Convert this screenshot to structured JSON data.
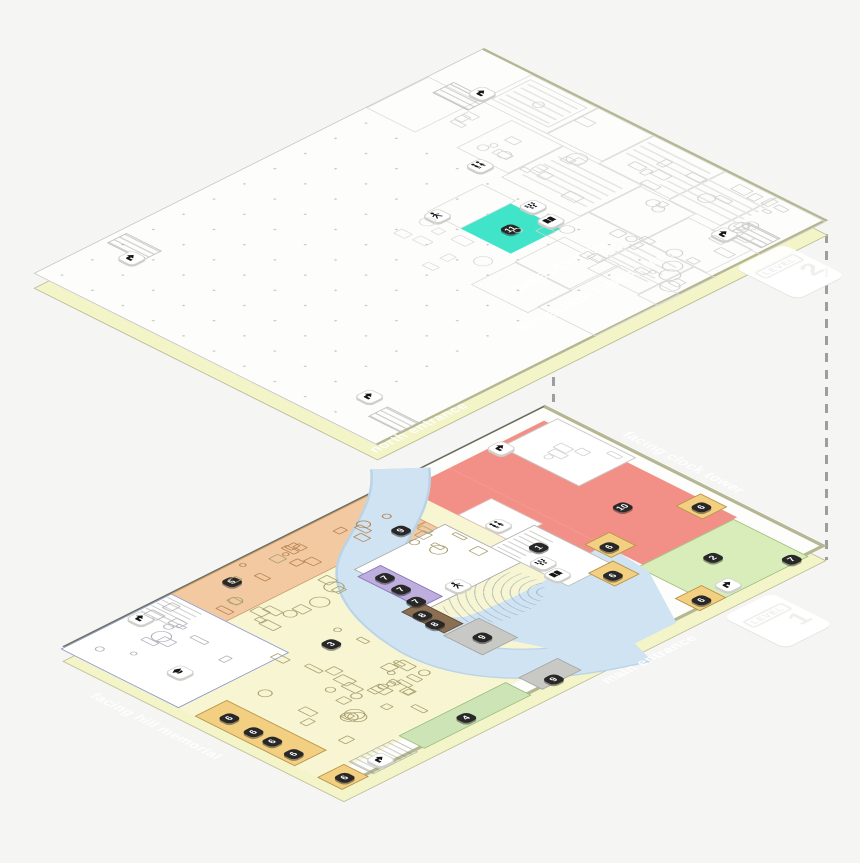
{
  "scene": {
    "background": "#f5f5f4"
  },
  "level2": {
    "badge": {
      "label": "LEVEL",
      "number": "2"
    },
    "highlight_room_color": "#3fe4c9",
    "room_labels": [
      {
        "text": "RECEPTION",
        "p": 286,
        "v": 191
      },
      {
        "text": "CONF.",
        "p": 288,
        "v": 243
      },
      {
        "text": "RESEARCH LIBRARIANS",
        "p": 334,
        "v": 205
      }
    ],
    "markers": [
      {
        "label": "11",
        "p": 210,
        "v": 178
      }
    ],
    "icons": [
      {
        "type": "stairs-icon",
        "p": 40,
        "v": 40
      },
      {
        "type": "stairs-icon",
        "p": 28,
        "v": 420
      },
      {
        "type": "stairs-icon",
        "p": 316,
        "v": 442
      },
      {
        "type": "stairs-icon",
        "p": 333,
        "v": 62
      },
      {
        "type": "restroom-icon",
        "p": 120,
        "v": 122
      },
      {
        "type": "person-icon",
        "p": 152,
        "v": 202
      },
      {
        "type": "audience-icon",
        "p": 195,
        "v": 138
      },
      {
        "type": "book-icon",
        "p": 221,
        "v": 144
      }
    ],
    "teal_room": {
      "x": 188,
      "y": 156,
      "w": 56,
      "h": 56,
      "color": "#3fe4c9"
    },
    "decor": {
      "rooms": [
        [
          55,
          0,
          75,
          58
        ],
        [
          130,
          0,
          62,
          58
        ],
        [
          192,
          0,
          80,
          62
        ],
        [
          272,
          0,
          58,
          64
        ],
        [
          330,
          0,
          55,
          74
        ],
        [
          95,
          62,
          58,
          62
        ],
        [
          153,
          62,
          88,
          70
        ],
        [
          241,
          64,
          62,
          58
        ],
        [
          303,
          72,
          72,
          52
        ],
        [
          241,
          122,
          62,
          50
        ],
        [
          303,
          124,
          58,
          62
        ],
        [
          361,
          124,
          24,
          64
        ],
        [
          150,
          150,
          38,
          62
        ],
        [
          255,
          163,
          62,
          56
        ],
        [
          256,
          219,
          64,
          50
        ],
        [
          318,
          163,
          66,
          94
        ],
        [
          60,
          6,
          64,
          44
        ],
        [
          0,
          60,
          55,
          70
        ]
      ],
      "stripes": [
        [
          250,
          14,
          86,
          38
        ],
        [
          162,
          70,
          72,
          48
        ],
        [
          300,
          128,
          52,
          40
        ],
        [
          64,
          10,
          56,
          36
        ],
        [
          196,
          6,
          70,
          30
        ]
      ],
      "hatches": [
        [
          20,
          52,
          40,
          24
        ],
        [
          6,
          404,
          40,
          22
        ],
        [
          346,
          452,
          36,
          22
        ],
        [
          342,
          44,
          36,
          22
        ]
      ],
      "dots_field": [
        0,
        130,
        340,
        374
      ]
    }
  },
  "level1": {
    "badge": {
      "label": "LEVEL",
      "number": "1"
    },
    "edge_labels": [
      {
        "text": "north entrance",
        "p": -48,
        "v": 92,
        "rot": -90
      },
      {
        "text": "facing clock tower",
        "p": 140,
        "v": -18,
        "rot": 0
      },
      {
        "text": "facing hill memorial",
        "p": 140,
        "v": 572,
        "rot": 0
      },
      {
        "text": "main entrance",
        "p": 340,
        "v": 222,
        "rot": -90
      }
    ],
    "markers": [
      {
        "label": "5",
        "p": 14,
        "v": 362
      },
      {
        "label": "9",
        "p": 51,
        "v": 210
      },
      {
        "label": "7",
        "p": 95,
        "v": 272
      },
      {
        "label": "7",
        "p": 117,
        "v": 276
      },
      {
        "label": "7",
        "p": 139,
        "v": 281
      },
      {
        "label": "8",
        "p": 158,
        "v": 293
      },
      {
        "label": "8",
        "p": 175,
        "v": 296
      },
      {
        "label": "9",
        "p": 216,
        "v": 284
      },
      {
        "label": "9",
        "p": 303,
        "v": 291
      },
      {
        "label": "3",
        "p": 139,
        "v": 376
      },
      {
        "label": "1",
        "p": 147,
        "v": 152
      },
      {
        "label": "10",
        "p": 149,
        "v": 60
      },
      {
        "label": "2",
        "p": 256,
        "v": 66
      },
      {
        "label": "7",
        "p": 302,
        "v": 24
      },
      {
        "label": "6",
        "p": 193,
        "v": 16
      },
      {
        "label": "6",
        "p": 186,
        "v": 112
      },
      {
        "label": "6",
        "p": 220,
        "v": 142
      },
      {
        "label": "6",
        "p": 297,
        "v": 120
      },
      {
        "label": "6",
        "p": 165,
        "v": 516
      },
      {
        "label": "6",
        "p": 194,
        "v": 518
      },
      {
        "label": "6",
        "p": 215,
        "v": 518
      },
      {
        "label": "6",
        "p": 241,
        "v": 520
      },
      {
        "label": "6",
        "p": 296,
        "v": 518
      },
      {
        "label": "4",
        "p": 297,
        "v": 383
      }
    ],
    "icons": [
      {
        "type": "stairs-icon",
        "p": 13,
        "v": 60
      },
      {
        "type": "stairs-icon",
        "p": 2,
        "v": 452
      },
      {
        "type": "stairs-icon",
        "p": 293,
        "v": 86
      },
      {
        "type": "stairs-icon",
        "p": 294,
        "v": 476
      },
      {
        "type": "gradcap-icon",
        "p": 84,
        "v": 490
      },
      {
        "type": "person-icon",
        "p": 143,
        "v": 238
      },
      {
        "type": "restroom-icon",
        "p": 98,
        "v": 148
      },
      {
        "type": "audience-icon",
        "p": 165,
        "v": 165
      },
      {
        "type": "book-icon",
        "p": 186,
        "v": 170
      }
    ],
    "zones": [
      {
        "id": "commons-yellow",
        "color": "#f8f5d2",
        "x": 0,
        "y": 162,
        "w": 292,
        "h": 378
      },
      {
        "id": "study-orange",
        "color": "#f3c9a2",
        "x": 0,
        "y": 193,
        "w": 62,
        "h": 232,
        "border": "#cf9c68"
      },
      {
        "id": "study-orange-2",
        "color": "#f3c9a2",
        "x": 62,
        "y": 193,
        "w": 34,
        "h": 72,
        "border": "#cf9c68"
      },
      {
        "id": "red-zone-a",
        "color": "#f29087",
        "x": 15,
        "y": 14,
        "w": 216,
        "h": 106
      },
      {
        "id": "red-zone-b",
        "color": "#f29087",
        "x": 15,
        "y": 120,
        "w": 176,
        "h": 48
      },
      {
        "id": "stacks-green",
        "color": "#d9edbb",
        "x": 231,
        "y": 18,
        "w": 84,
        "h": 108,
        "pattern": "shelves",
        "border": "#9cbd7e"
      }
    ],
    "overlays": [
      {
        "id": "room-top",
        "color": "#ffffff",
        "x": 20,
        "y": 4,
        "w": 88,
        "h": 64,
        "border": "#c2c2bf"
      },
      {
        "id": "red-cutout",
        "color": "#ffffff",
        "x": 72,
        "y": 130,
        "w": 58,
        "h": 38,
        "border": "#d8b5b0"
      },
      {
        "id": "center-white",
        "color": "#ffffff",
        "x": 75,
        "y": 185,
        "w": 86,
        "h": 102,
        "border": "#a2a2a6"
      },
      {
        "id": "river-rooms",
        "color": "#ffffff",
        "x": 126,
        "y": 136,
        "w": 88,
        "h": 50,
        "border": "#b5b5b2"
      },
      {
        "id": "river-rooms-hatch",
        "color": "#ffffff",
        "x": 130,
        "y": 140,
        "w": 26,
        "h": 42,
        "pattern": "hatch"
      },
      {
        "id": "purple-strip",
        "color": "#beaedd",
        "x": 85,
        "y": 267,
        "w": 70,
        "h": 26,
        "border": "#8471b5"
      },
      {
        "id": "brown-strip",
        "color": "#8a6f52",
        "x": 149,
        "y": 286,
        "w": 48,
        "h": 22,
        "border": "#5f4a33"
      },
      {
        "id": "gray-zone",
        "color": "#c8c8c5",
        "x": 199,
        "y": 271,
        "w": 44,
        "h": 40,
        "border": "#a5a5a2"
      },
      {
        "id": "gray-edge",
        "color": "#c8c8c5",
        "x": 288,
        "y": 272,
        "w": 27,
        "h": 44,
        "border": "#a5a5a2"
      },
      {
        "id": "green-strip",
        "color": "#cde4b6",
        "x": 286,
        "y": 328,
        "w": 29,
        "h": 120,
        "border": "#9cbd7e"
      },
      {
        "id": "stair-nook",
        "color": "#ffffff",
        "x": 287,
        "y": 455,
        "w": 28,
        "h": 50,
        "pattern": "hatch",
        "border": "#b5b5b2"
      },
      {
        "id": "amber-corner",
        "color": "#f3cf82",
        "x": 287,
        "y": 510,
        "w": 28,
        "h": 30,
        "border": "#b08f45"
      },
      {
        "id": "amber-a",
        "color": "#f3cf82",
        "x": 184,
        "y": 8,
        "w": 30,
        "h": 28,
        "border": "#b08f45"
      },
      {
        "id": "amber-b",
        "color": "#f3cf82",
        "x": 176,
        "y": 102,
        "w": 30,
        "h": 28,
        "border": "#b08f45"
      },
      {
        "id": "amber-c",
        "color": "#f3cf82",
        "x": 210,
        "y": 132,
        "w": 30,
        "h": 28,
        "border": "#b08f45"
      },
      {
        "id": "amber-d",
        "color": "#f3cf82",
        "x": 287,
        "y": 110,
        "w": 28,
        "h": 30,
        "border": "#b08f45"
      },
      {
        "id": "amber-band",
        "color": "#f3cf82",
        "x": 150,
        "y": 504,
        "w": 112,
        "h": 36,
        "pattern": "dividers",
        "border": "#b08f45"
      },
      {
        "id": "white-room-left",
        "color": "#ffffff",
        "x": 0,
        "y": 416,
        "w": 132,
        "h": 124,
        "border": "#8792c9"
      },
      {
        "id": "white-room-hatch",
        "color": "#ffffff",
        "x": 2,
        "y": 419,
        "w": 38,
        "h": 34,
        "pattern": "hatch"
      }
    ],
    "river": {
      "color": "#cfe3f2",
      "edge": "#b9d4e6",
      "width": 44,
      "stroke_path": "M -12,148 C 30,185 45,225 70,265 C 95,303 140,325 195,330 C 250,333 295,295 322,215",
      "fill_path": "M 186,118 L 242,124 L 315,166 L 315,256 C 268,264 232,282 207,300 C 185,315 168,318 156,316 L 150,292 C 166,296 180,292 190,278 C 198,248 196,170 186,118 Z"
    }
  },
  "furniture": [
    {
      "plan": "level1",
      "rect": [
        15,
        298,
        100,
        115
      ],
      "count": 14,
      "color": "#a9a172",
      "seed": 3
    },
    {
      "plan": "level1",
      "rect": [
        120,
        355,
        150,
        140
      ],
      "count": 22,
      "color": "#a9a172",
      "seed": 7
    },
    {
      "plan": "level1",
      "rect": [
        58,
        176,
        80,
        55
      ],
      "count": 7,
      "color": "#a9a172",
      "seed": 11
    },
    {
      "plan": "level1",
      "rect": [
        212,
        330,
        68,
        160
      ],
      "count": 12,
      "color": "#a9a172",
      "seed": 13
    },
    {
      "plan": "level1",
      "rect": [
        3,
        200,
        56,
        215
      ],
      "count": 14,
      "color": "#b5834f",
      "seed": 17
    },
    {
      "plan": "level1",
      "rect": [
        6,
        424,
        118,
        105
      ],
      "count": 12,
      "color": "#b2b2bc",
      "seed": 19
    },
    {
      "plan": "level1",
      "rect": [
        24,
        8,
        80,
        56
      ],
      "count": 5,
      "color": "#d2d2cf",
      "seed": 23
    },
    {
      "plan": "level2",
      "rect": [
        200,
        4,
        182,
        190
      ],
      "count": 40,
      "color": "#d2d2cf",
      "seed": 29
    },
    {
      "plan": "level2",
      "rect": [
        58,
        4,
        140,
        120
      ],
      "count": 16,
      "color": "#d6d6d3",
      "seed": 31
    },
    {
      "plan": "level2",
      "rect": [
        150,
        210,
        100,
        80
      ],
      "count": 8,
      "color": "#dddddb",
      "seed": 37
    }
  ]
}
